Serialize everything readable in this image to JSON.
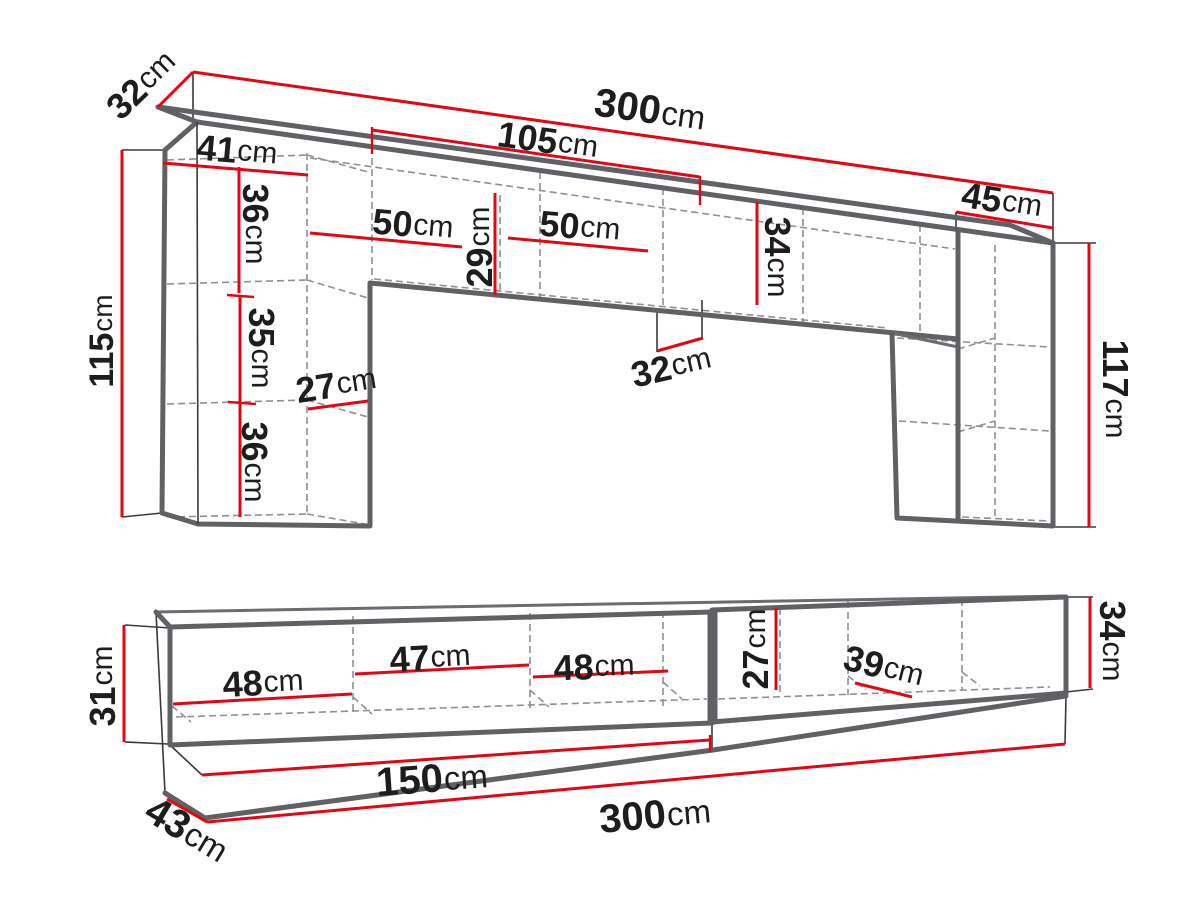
{
  "diagram_type": "furniture dimension drawing",
  "colors": {
    "dimension_red": "#e30613",
    "outline_gray": "#5f6165",
    "hidden_gray": "#909092",
    "text": "#1d1d1b",
    "background": "#ffffff"
  },
  "upper": {
    "name": "wall unit with two tall columns and top bridge",
    "d32_top": {
      "v": "32",
      "u": "cm"
    },
    "d300": {
      "v": "300",
      "u": "cm"
    },
    "d105": {
      "v": "105",
      "u": "cm"
    },
    "d41": {
      "v": "41",
      "u": "cm"
    },
    "d36_top": {
      "v": "36",
      "u": "cm"
    },
    "d50_left": {
      "v": "50",
      "u": "cm"
    },
    "d29": {
      "v": "29",
      "u": "cm"
    },
    "d50_right": {
      "v": "50",
      "u": "cm"
    },
    "d34": {
      "v": "34",
      "u": "cm"
    },
    "d45": {
      "v": "45",
      "u": "cm"
    },
    "d115": {
      "v": "115",
      "u": "cm"
    },
    "d35": {
      "v": "35",
      "u": "cm"
    },
    "d27": {
      "v": "27",
      "u": "cm"
    },
    "d36_bot": {
      "v": "36",
      "u": "cm"
    },
    "d32_mid": {
      "v": "32",
      "u": "cm"
    },
    "d117": {
      "v": "117",
      "u": "cm"
    }
  },
  "lower": {
    "name": "TV stand / sideboard",
    "d31": {
      "v": "31",
      "u": "cm"
    },
    "d48_left": {
      "v": "48",
      "u": "cm"
    },
    "d47": {
      "v": "47",
      "u": "cm"
    },
    "d48_right": {
      "v": "48",
      "u": "cm"
    },
    "d27": {
      "v": "27",
      "u": "cm"
    },
    "d39": {
      "v": "39",
      "u": "cm"
    },
    "d34": {
      "v": "34",
      "u": "cm"
    },
    "d150": {
      "v": "150",
      "u": "cm"
    },
    "d300": {
      "v": "300",
      "u": "cm"
    },
    "d43": {
      "v": "43",
      "u": "cm"
    }
  }
}
